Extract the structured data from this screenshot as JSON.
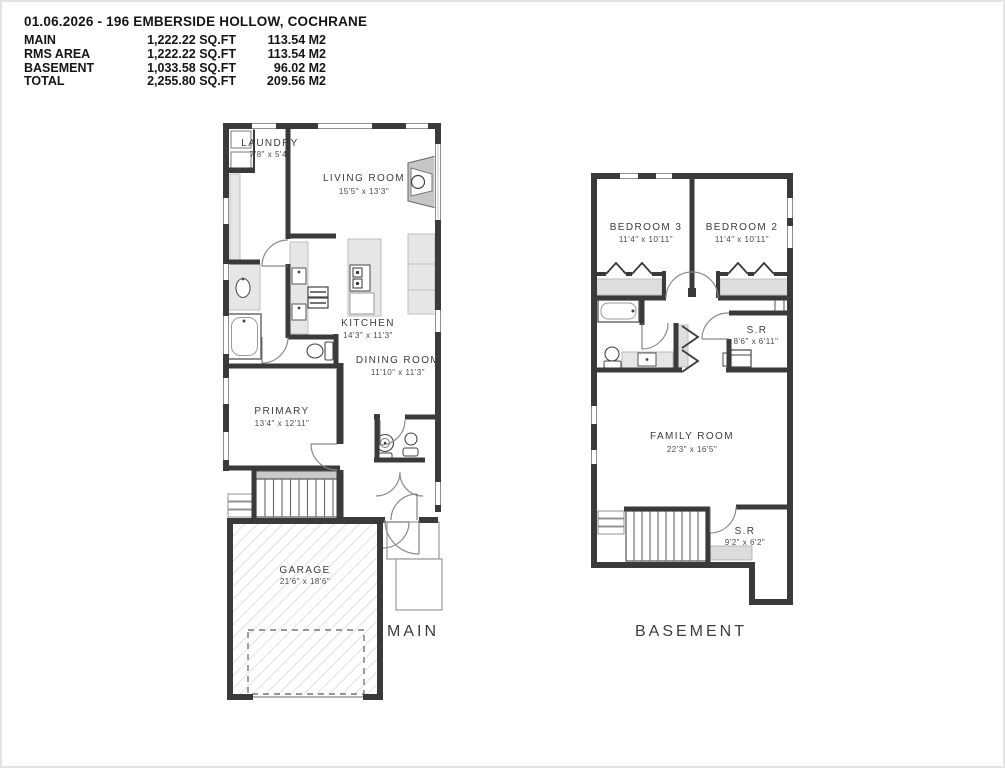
{
  "header": {
    "title": "01.06.2026 - 196 EMBERSIDE HOLLOW, COCHRANE",
    "area_rows": [
      {
        "label": "MAIN",
        "sqft": "1,222.22 SQ.FT",
        "m2": "113.54 M2"
      },
      {
        "label": "RMS AREA",
        "sqft": "1,222.22 SQ.FT",
        "m2": "113.54 M2"
      },
      {
        "label": "BASEMENT",
        "sqft": "1,033.58 SQ.FT",
        "m2": "96.02 M2"
      },
      {
        "label": "TOTAL",
        "sqft": "2,255.80 SQ.FT",
        "m2": "209.56 M2"
      }
    ]
  },
  "main_floor": {
    "caption": "MAIN",
    "rooms": {
      "laundry": {
        "name": "LAUNDRY",
        "dims": "7'8\" x 5'4\""
      },
      "living": {
        "name": "LIVING ROOM",
        "dims": "15'5\" x 13'3\""
      },
      "kitchen": {
        "name": "KITCHEN",
        "dims": "14'3\" x 11'3\""
      },
      "dining": {
        "name": "DINING ROOM",
        "dims": "11'10\" x 11'3\""
      },
      "primary": {
        "name": "PRIMARY",
        "dims": "13'4\" x 12'11\""
      },
      "garage": {
        "name": "GARAGE",
        "dims": "21'6\" x 18'6\""
      }
    }
  },
  "basement": {
    "caption": "BASEMENT",
    "rooms": {
      "bedroom3": {
        "name": "BEDROOM 3",
        "dims": "11'4\" x 10'11\""
      },
      "bedroom2": {
        "name": "BEDROOM 2",
        "dims": "11'4\" x 10'11\""
      },
      "storage1": {
        "name": "S.R",
        "dims": "8'6\" x 6'11\""
      },
      "family": {
        "name": "FAMILY ROOM",
        "dims": "22'3\" x 16'5\""
      },
      "storage2": {
        "name": "S.R",
        "dims": "9'2\" x 6'2\""
      }
    }
  },
  "colors": {
    "wall": "#3a3a3a",
    "fixture_fill": "#e2e2e2",
    "counter_fill": "#e6e6e6",
    "stair_landing": "#c9c9c9",
    "hatch_line": "#e9e9e9",
    "text": "#3d3d3d",
    "page_border": "#e3e3e3"
  }
}
